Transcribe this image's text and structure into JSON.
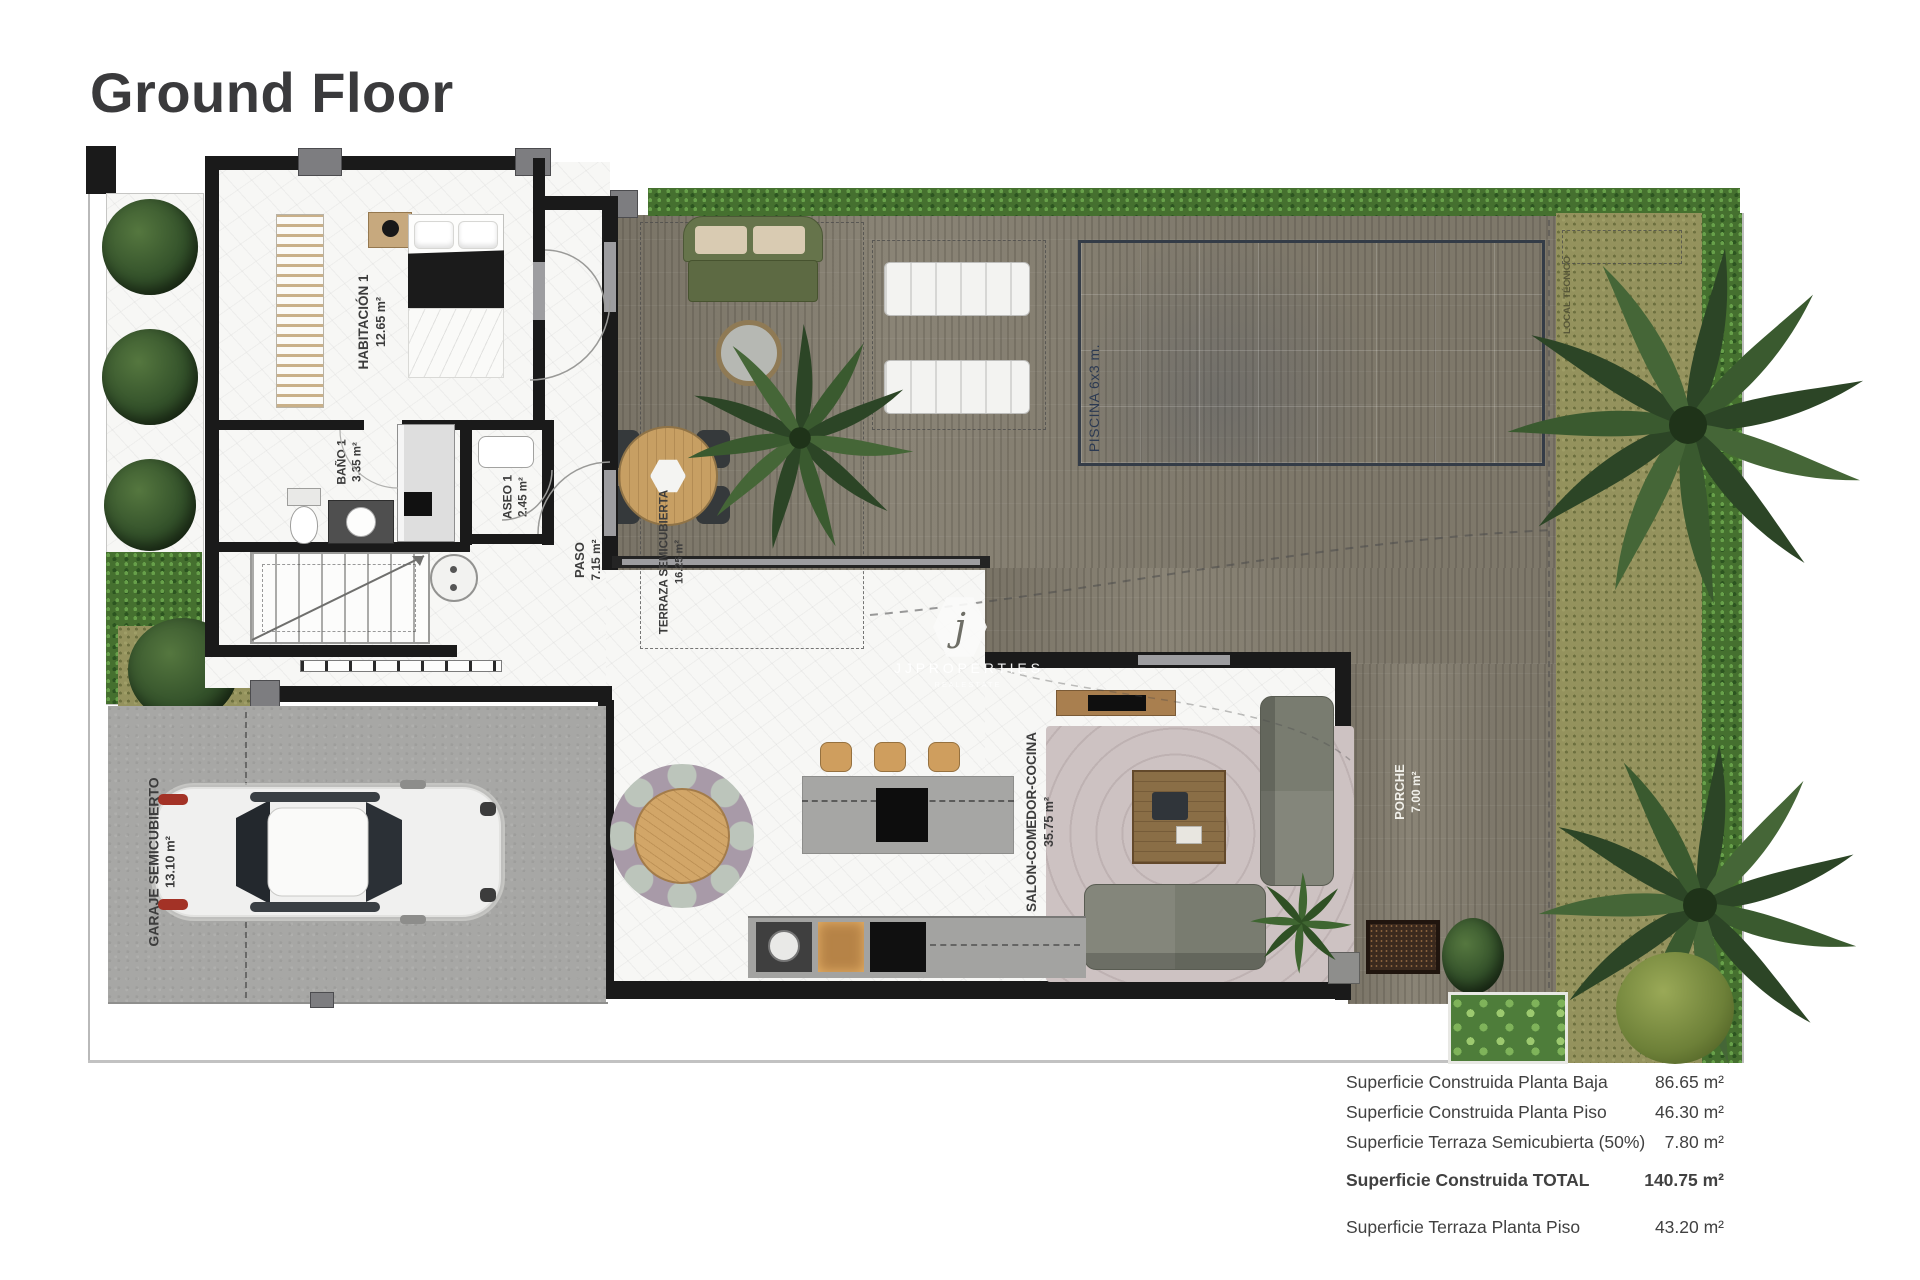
{
  "title": "Ground Floor",
  "watermark": {
    "initial": "j",
    "name": "J J   P R O P E R T I E S",
    "tagline": "R E A L   E S T A T E"
  },
  "rooms": {
    "habitacion": {
      "name": "HABITACIÓN 1",
      "area": "12.65 m²"
    },
    "bano": {
      "name": "BAÑO 1",
      "area": "3.35 m²"
    },
    "aseo": {
      "name": "ASEO 1",
      "area": "2.45 m²"
    },
    "paso": {
      "name": "PASO",
      "area": "7.15 m²"
    },
    "terraza": {
      "name": "TERRAZA SEMICUBIERTA",
      "area": "16.25 m²"
    },
    "garaje": {
      "name": "GARAJE SEMICUBIERTO",
      "area": "13.10 m²"
    },
    "salon": {
      "name": "SALON-COMEDOR-COCINA",
      "area": "35.75 m²"
    },
    "porche": {
      "name": "PORCHE",
      "area": "7.00 m²"
    },
    "piscina": {
      "name": "PISCINA 6x3 m."
    },
    "local_tecnico": {
      "name": "LOCAL TÉCNICO"
    }
  },
  "summary": {
    "rows": [
      {
        "label": "Superficie Construida Planta Baja",
        "value": "86.65 m²"
      },
      {
        "label": "Superficie Construida Planta Piso",
        "value": "46.30 m²"
      },
      {
        "label": "Superficie Terraza Semicubierta (50%)",
        "value": "7.80 m²"
      },
      {
        "label": "Superficie Construida TOTAL",
        "value": "140.75 m²"
      },
      {
        "label": "Superficie Terraza Planta Piso",
        "value": "43.20 m²"
      }
    ]
  },
  "colors": {
    "pool": "#8aa5c9",
    "deck": "#8a8476",
    "hedge": "#45702f",
    "grass": "#94925d",
    "wall": "#1a1a1a",
    "accent_text": "#3c3c3c"
  }
}
